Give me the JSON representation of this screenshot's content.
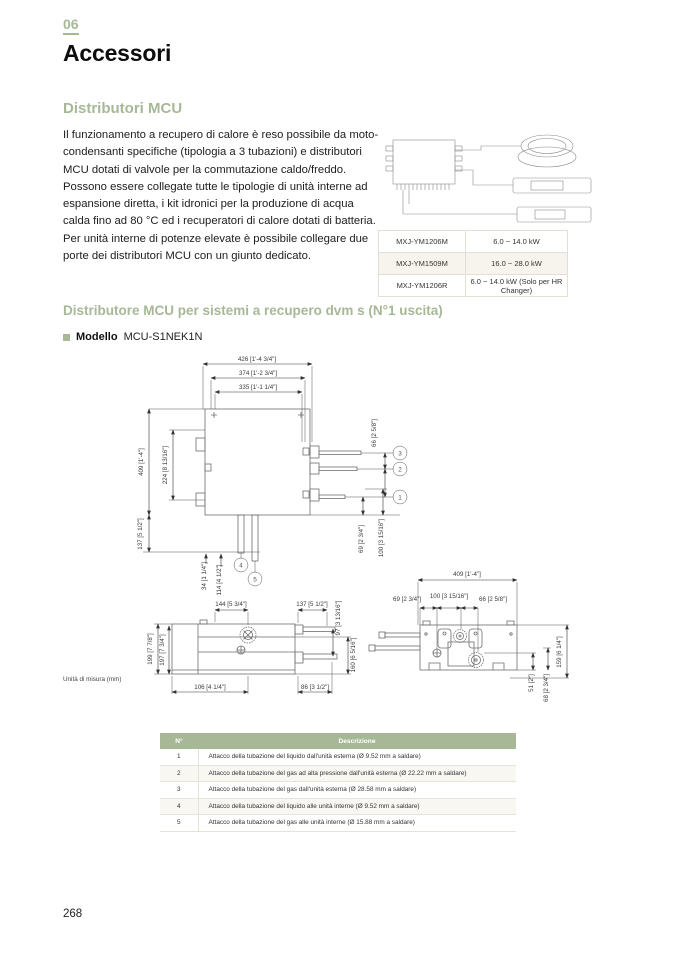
{
  "page": {
    "chapter_number": "06",
    "chapter_title": "Accessori",
    "page_number": "268"
  },
  "intro": {
    "heading": "Distributori MCU",
    "paragraph1": "Il funzionamento a recupero di calore è reso possibile da moto-condensanti specifiche (tipologia a 3 tubazioni) e distributori MCU dotati di valvole per la commutazione caldo/freddo. Possono essere collegate tutte le tipologie di unità interne ad espansione diretta, i kit idronici per la produzione di acqua calda fino ad 80 °C ed i recuperatori di calore dotati di batteria.",
    "paragraph2": "Per unità interne di potenze elevate è possibile collegare due porte dei distributori MCU con un giunto dedicato."
  },
  "models_table": {
    "rows": [
      {
        "model": "MXJ-YM1206M",
        "capacity": "6.0 ~ 14.0 kW"
      },
      {
        "model": "MXJ-YM1509M",
        "capacity": "16.0 ~ 28.0 kW"
      },
      {
        "model": "MXJ-YM1206R",
        "capacity": "6.0 ~ 14.0 kW (Solo per HR Changer)"
      }
    ]
  },
  "section": {
    "heading": "Distributore MCU per sistemi a recupero dvm s (N°1 uscita)",
    "model_label": "Modello",
    "model_value": "MCU-S1NEK1N"
  },
  "drawings": {
    "units_note": "Unità di misura (mm)",
    "plan": {
      "dims": {
        "d426": "426 [1'-4 3/4\"]",
        "d374": "374 [1'-2 3/4\"]",
        "d335": "335 [1'-1 1/4\"]",
        "d409": "409 [1'-4\"]",
        "d224": "224 [8 13/16\"]",
        "d137": "137 [5 1/2\"]",
        "d34": "34 [1 1/4\"]",
        "d114": "114 [4 1/2\"]",
        "d66": "66 [2 5/8\"]",
        "d100": "100 [3 15/16\"]",
        "d69": "69 [2 3/4\"]"
      },
      "callouts": {
        "c1": "1",
        "c2": "2",
        "c3": "3",
        "c4": "4",
        "c5": "5"
      }
    },
    "front": {
      "dims": {
        "d144": "144 [5 3/4\"]",
        "d137": "137 [5 1/2\"]",
        "d97": "97 [3 13/16\"]",
        "d199": "199 [7 7/8\"]",
        "d197": "197 [7 3/4\"]",
        "d160": "160 [6 5/16\"]",
        "d106": "106 [4 1/4\"]",
        "d86": "86 [3 1/2\"]"
      }
    },
    "side": {
      "dims": {
        "d409": "409 [1'-4\"]",
        "d69": "69 [2 3/4\"]",
        "d100": "100 [3 15/16\"]",
        "d66": "66 [2 5/8\"]",
        "d159": "159 [6 1/4\"]",
        "d51": "51 [2\"]",
        "d68": "68 [2 3/4\"]"
      }
    }
  },
  "legend_table": {
    "headers": [
      "N°",
      "Descrizione"
    ],
    "rows": [
      {
        "n": "1",
        "desc": "Attacco della tubazione del liquido dall'unità esterna (Ø 9.52 mm a saldare)"
      },
      {
        "n": "2",
        "desc": "Attacco della tubazione del gas ad alta pressione dall'unità esterna (Ø 22.22 mm a saldare)"
      },
      {
        "n": "3",
        "desc": "Attacco della tubazione del gas dall'unità esterna (Ø 28.58 mm a saldare)"
      },
      {
        "n": "4",
        "desc": "Attacco della tubazione del liquido alle unità interne (Ø 9.52 mm a saldare)"
      },
      {
        "n": "5",
        "desc": "Attacco della tubazione del gas alle unità interne (Ø 15.88 mm a saldare)"
      }
    ]
  }
}
